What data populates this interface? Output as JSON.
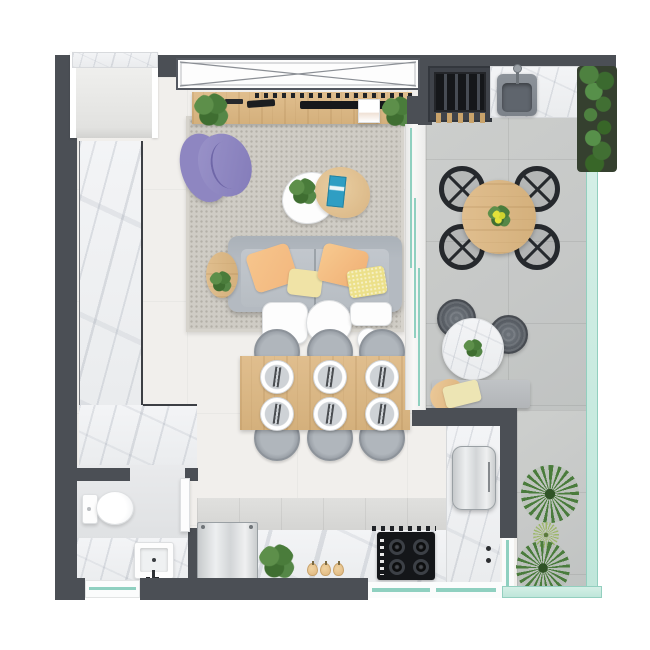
{
  "scene": {
    "kind": "apartment-floor-plan-render",
    "view": "top-down",
    "visible_text": "none"
  },
  "colors": {
    "page": "#ffffff",
    "wall": "#4b4f55",
    "floor": "#f1efec",
    "terrace": "#c6c8c7",
    "marble": "#f3f4f6",
    "rug": "#cfccc5",
    "wood": "#e0be8e",
    "glass": "#bfe6da",
    "glassline": "#8fd0c0",
    "green": "#4a7c3c",
    "sofa": "#b4bac1",
    "purple": "#8e86c1",
    "peach": "#f3b77e",
    "paleyellow": "#f0e3a6",
    "chairgray": "#9ba1a8",
    "black": "#26292d",
    "cooktop": "#141619"
  },
  "inventory": {
    "living_room": [
      "window",
      "media-sideboard",
      "tv",
      "speakers",
      "picture-frame",
      "plant",
      "plant",
      "lounge-chair",
      "coffee-table-white",
      "coffee-table-wood",
      "potted-plant",
      "book",
      "sofa",
      "pillow",
      "pillow",
      "pillow",
      "pillow",
      "side-table",
      "console-table",
      "console-table",
      "console-table",
      "console-table",
      "area-rug"
    ],
    "dining_area": [
      "dining-table",
      "chair",
      "chair",
      "chair",
      "chair",
      "chair",
      "chair",
      "place-setting",
      "place-setting",
      "place-setting",
      "place-setting",
      "place-setting",
      "place-setting"
    ],
    "kitchen": [
      "refrigerator",
      "countertop",
      "cooktop",
      "vent",
      "plant",
      "fruit",
      "fruit",
      "fruit",
      "counter-appliance",
      "faucet"
    ],
    "bathroom": [
      "toilet",
      "vanity-sink",
      "door",
      "window"
    ],
    "entry": [
      "alcove",
      "marble-counter"
    ],
    "balcony": [
      "grill",
      "skewers",
      "outdoor-sink",
      "sink-counter",
      "vertical-garden",
      "round-dining-table",
      "chair",
      "chair",
      "chair",
      "chair",
      "bistro-table",
      "pouf",
      "pouf",
      "bench",
      "blanket",
      "palm-plant",
      "palm-plant",
      "small-plant",
      "glass-railing-right",
      "glass-railing-bottom",
      "sliding-glass-door"
    ]
  },
  "counts": {
    "balcony_chairs": 4,
    "dining_chairs": 6,
    "place_settings": 6,
    "burners": 4,
    "poufs": 2
  }
}
